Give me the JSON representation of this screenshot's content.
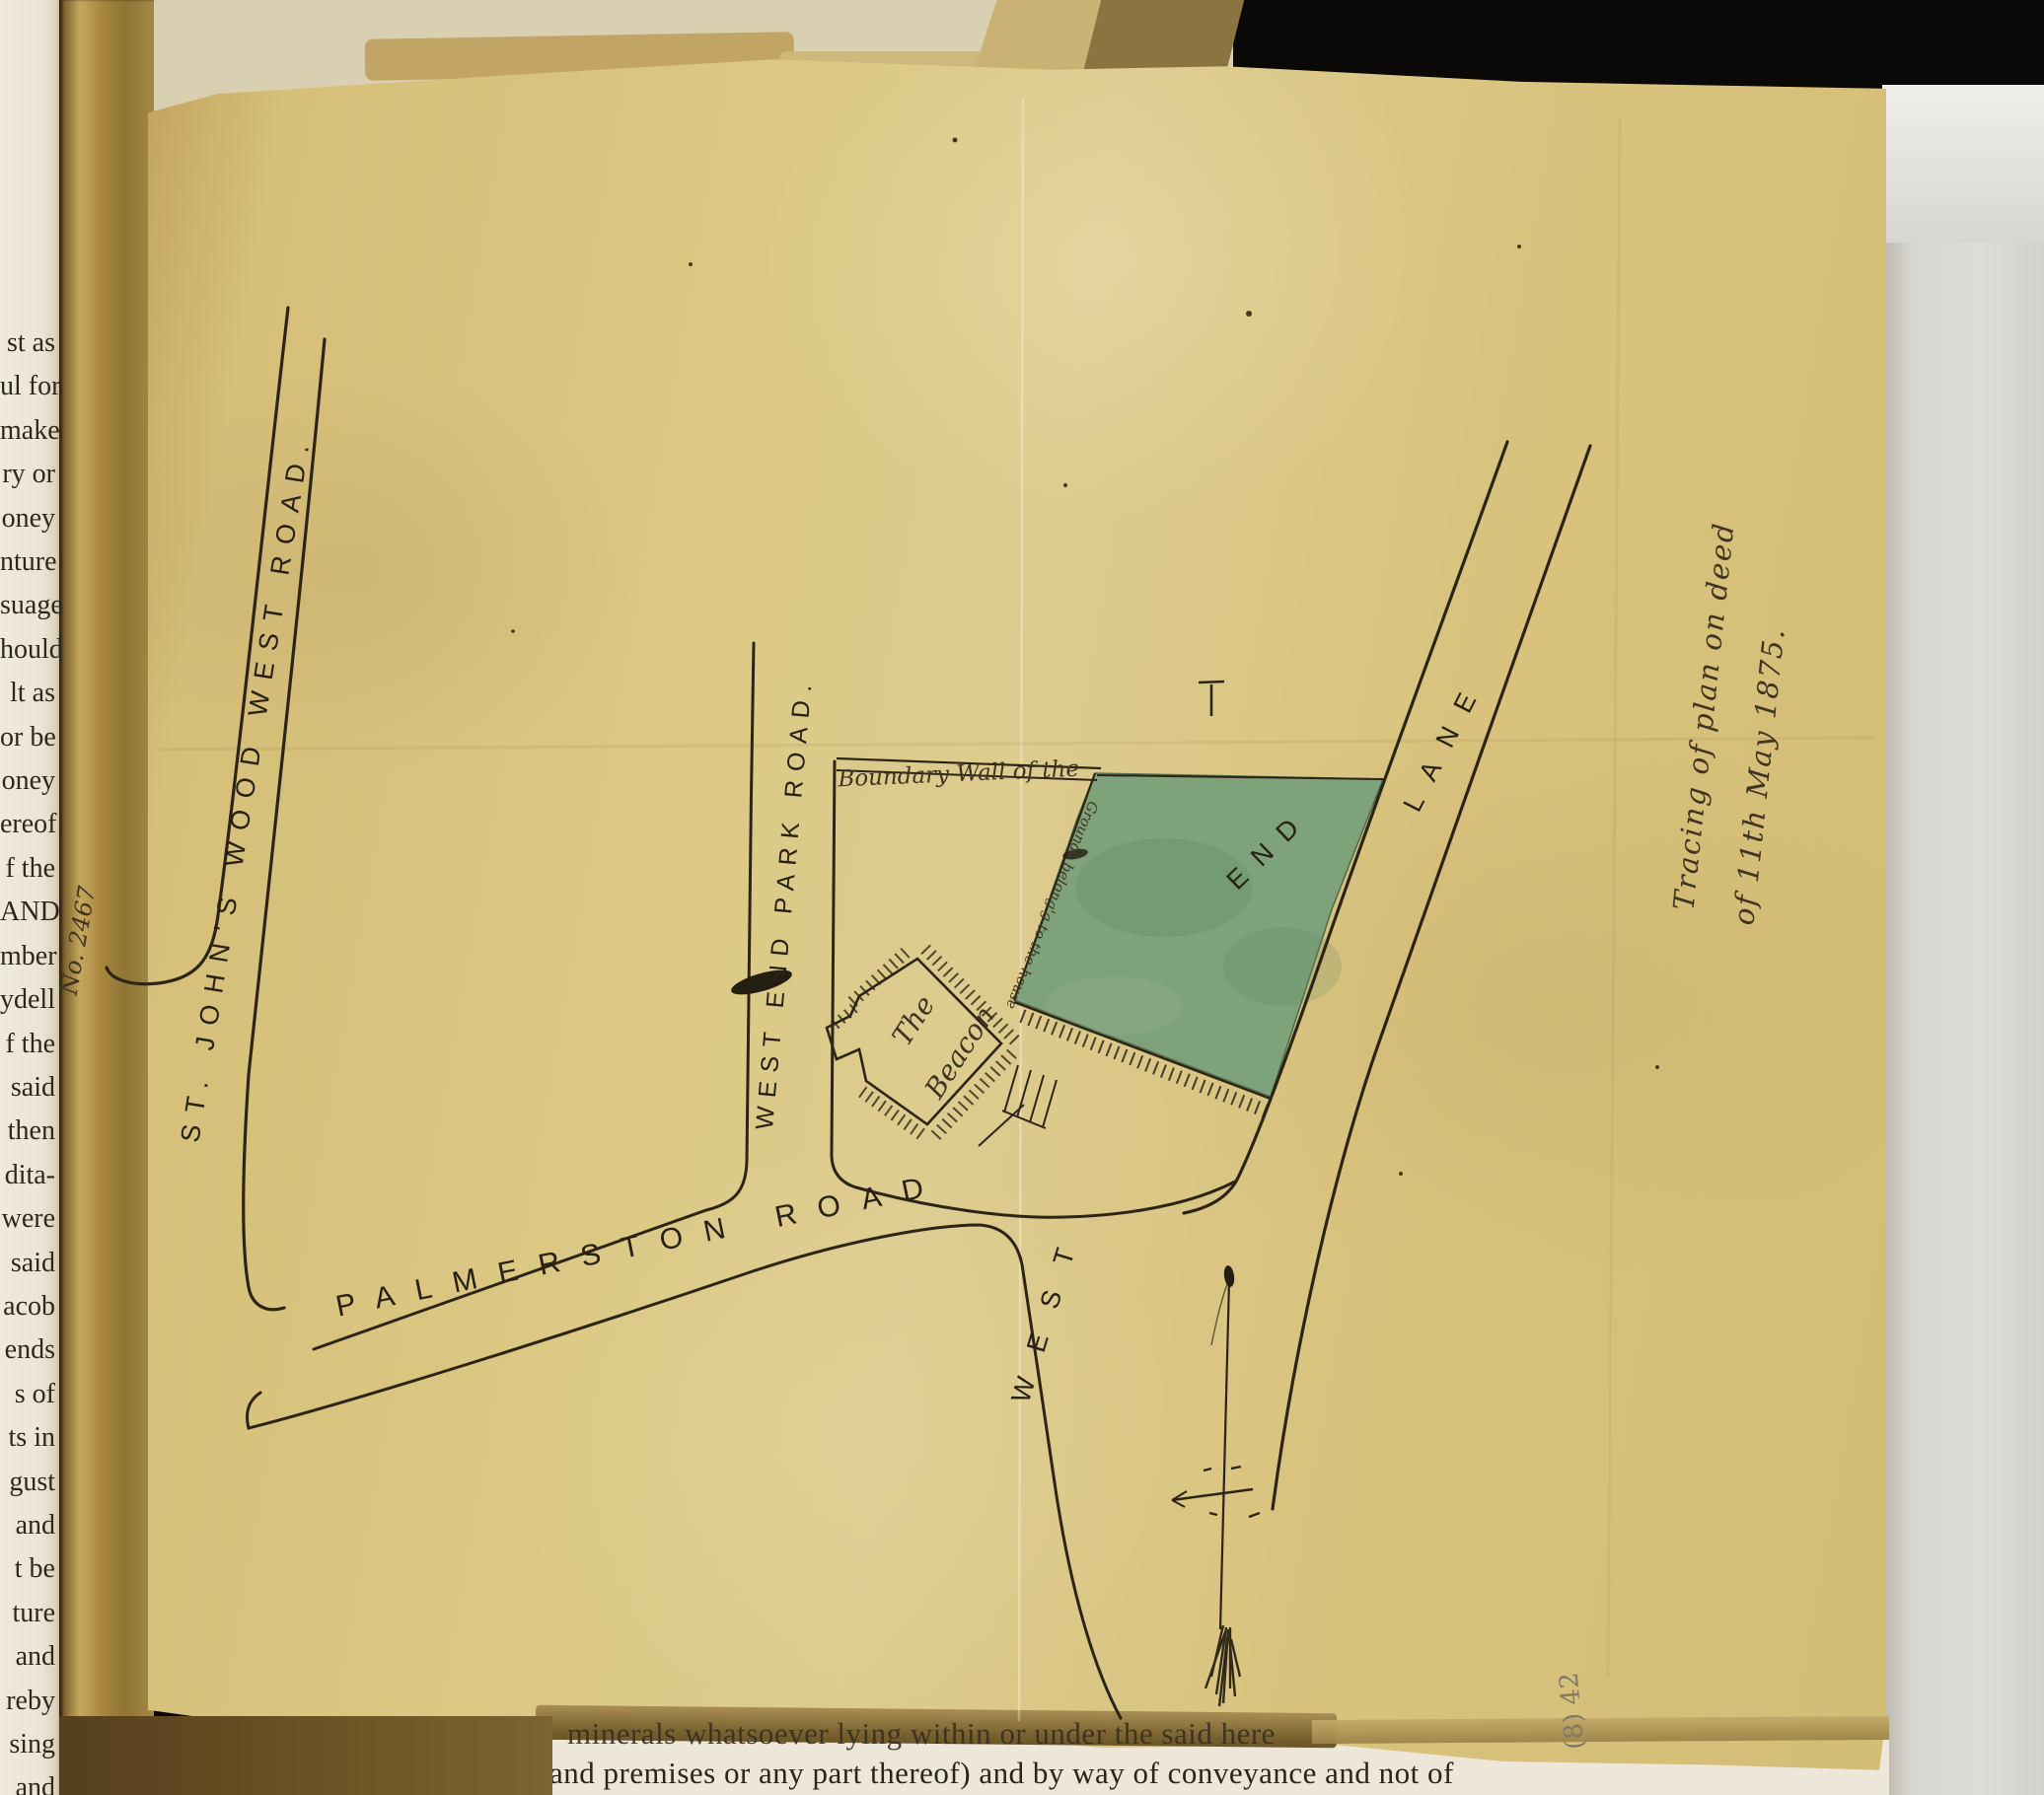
{
  "document": {
    "type_note_line1": "Tracing of plan on deed",
    "type_note_line2": "of 11th May 1875.",
    "archive_number": "No. 2467",
    "pencil_mark": "(8) 42"
  },
  "map": {
    "roads": {
      "st_johns_wood_west_road": "ST. JOHN'S  WOOD  WEST  ROAD.",
      "west_end_park_road": "WEST END PARK ROAD.",
      "palmerston_road": "PALMERSTON ROAD",
      "west_end_lane": {
        "full": "WEST END LANE",
        "parts": [
          "WEST",
          "END",
          "LANE"
        ]
      }
    },
    "labels": {
      "boundary_wall": "Boundary Wall of the",
      "grounds": "Grounds belong'g to the house",
      "building_line1": "The",
      "building_line2": "Beacon"
    },
    "plot_color": "#7ea27a",
    "ink_color": "#2c2517",
    "compass": "north-arrow"
  },
  "book_page": {
    "left_margin_fragments": [
      "st as",
      "ul for",
      "make",
      "ry or",
      "oney",
      "nture",
      "suage",
      "hould",
      "lt as",
      "or be",
      "oney",
      "ereof",
      "f the",
      "AND",
      "mber",
      "ydell",
      "f the",
      "said",
      "then",
      "dita-",
      "were",
      "said",
      "acob",
      "ends",
      "s of",
      "ts in",
      "gust",
      "and",
      "t be",
      "ture",
      "and",
      "reby",
      "sing",
      "and",
      "nce"
    ],
    "bottom_line1": "minerals whatsoever lying within or under the said here",
    "bottom_line2": "and premises or any part thereof) and by way of conveyance and not of"
  }
}
